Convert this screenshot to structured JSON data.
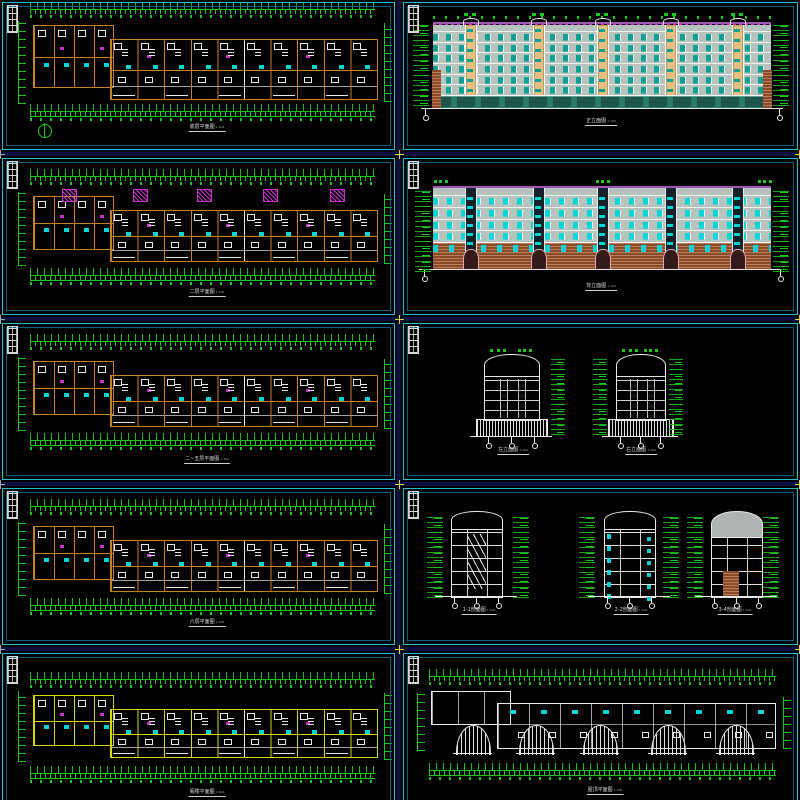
{
  "app": {
    "description": "CAD multi-sheet preview montage of residential building drawings",
    "background": "#000000",
    "gap_color": "#0c1140",
    "border_outer": "#1ac2cc",
    "border_inner": "#0e5f7a",
    "junction_mark_color": "#d9d93c",
    "junction_mark_edge_color": "#9aa8a8"
  },
  "palette": {
    "green": "#19c619",
    "orange": "#c87f1f",
    "yellow": "#d6d600",
    "cyan": "#00d6d6",
    "magenta": "#cf2fcf",
    "white": "#e8e8e8",
    "gray_wall": "#b7c3bd",
    "teal_window": "#0ea091",
    "teal_dark": "#2b7a6b",
    "tan": "#e6c083",
    "purple": "#a055b0",
    "brick": "#8a4a28",
    "brick_light": "#b97c5e",
    "pink": "#eaa6ad",
    "gray_fill": "#b0b4b0"
  },
  "sheets": [
    {
      "id": "plan-ground",
      "type": "floor-plan",
      "title": "底层平面图",
      "scale": "1:100",
      "units": 10,
      "canopies": 0,
      "wall": "orange",
      "has_north_arrow": true
    },
    {
      "id": "elev-front",
      "type": "elevation-front",
      "title": "正立面图",
      "scale": "1:100",
      "floors": 6,
      "stair_towers": 5
    },
    {
      "id": "plan-2f",
      "type": "floor-plan",
      "title": "二层平面图",
      "scale": "1:100",
      "units": 10,
      "canopies": 5,
      "wall": "orange",
      "has_north_arrow": false
    },
    {
      "id": "elev-rear",
      "type": "elevation-rear",
      "title": "背立面图",
      "scale": "1:100",
      "floors": 6,
      "entrances": 5,
      "stair_towers": 5
    },
    {
      "id": "plan-mid",
      "type": "floor-plan",
      "title": "二~五层平面图",
      "scale": "1:100",
      "units": 10,
      "canopies": 0,
      "wall": "orange",
      "has_north_arrow": false
    },
    {
      "id": "side-elevs",
      "type": "side-elevations",
      "floors": 7,
      "items": [
        {
          "title": "左立面图",
          "scale": "1:100"
        },
        {
          "title": "右立面图",
          "scale": "1:100"
        }
      ]
    },
    {
      "id": "plan-top",
      "type": "floor-plan",
      "title": "六层平面图",
      "scale": "1:100",
      "units": 10,
      "canopies": 0,
      "wall": "orange",
      "has_north_arrow": false
    },
    {
      "id": "sections",
      "type": "sections",
      "floors": 6,
      "items": [
        {
          "title": "1-1剖面图",
          "scale": "1:100"
        },
        {
          "title": "2-2剖面图",
          "scale": "1:100"
        },
        {
          "title": "3-4剖面图",
          "scale": "1:100"
        }
      ]
    },
    {
      "id": "plan-attic",
      "type": "floor-plan",
      "title": "阁楼平面图",
      "scale": "1:100",
      "units": 10,
      "canopies": 0,
      "wall": "yellow",
      "has_north_arrow": false
    },
    {
      "id": "roof-plan",
      "type": "roof-plan",
      "title": "屋顶平面图",
      "scale": "1:100",
      "roof_fans": 5
    }
  ]
}
